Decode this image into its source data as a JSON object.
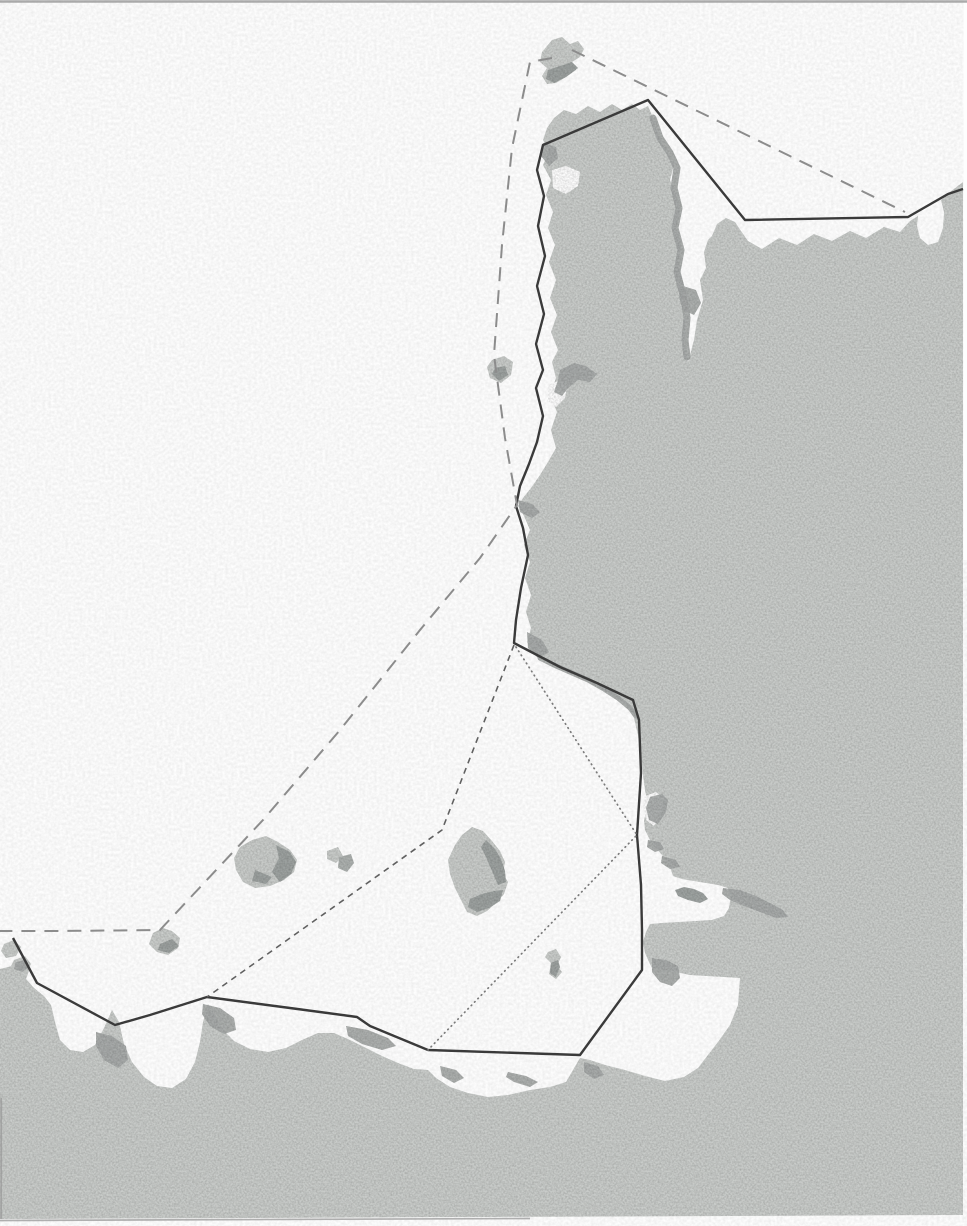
{
  "page": {
    "description": "Scanned grayscale nautical-style map of the Gulf of Saint-Malo / Channel Islands area; coastlines in light gray with darker shaded patches, maritime boundary lines drawn as solid, long-dash, short-dash and dotted strokes. No text labels are visible.",
    "labels": [],
    "width": 967,
    "height": 1226
  },
  "map": {
    "colors": {
      "sea": "#fefefe",
      "land": "#cacdcb",
      "land_shadow": "#a5a9a7",
      "island_shadow": "#9ba09e",
      "boundary_solid": "#3a3a3a",
      "boundary_long_dash": "#8c8c8c",
      "boundary_short_dash": "#606060",
      "boundary_dotted": "#7a7a7a",
      "page_edge": "#979797"
    },
    "line_styles": {
      "solid": {
        "color": "#3a3a3a",
        "width": 2.4,
        "dash": ""
      },
      "long-dash": {
        "color": "#8c8c8c",
        "width": 2.0,
        "dash": "14 9"
      },
      "short-dash": {
        "color": "#606060",
        "width": 1.6,
        "dash": "6 5"
      },
      "dotted": {
        "color": "#7a7a7a",
        "width": 1.7,
        "dash": "0.6 4.2",
        "cap": "round"
      }
    },
    "landmasses": [
      {
        "name": "mainland-france-and-brittany",
        "d": "M963,182 L950,192 941,200 944,212 943,228 938,242 928,245 920,238 917,226 918,216 910,221 900,232 884,227 866,238 850,231 832,241 814,234 797,245 779,238 762,249 748,241 741,231 735,222 726,218 717,224 712,236 708,240 704,252 706,268 700,280 703,300 697,320 694,340 690,355 688,362 684,345 686,325 681,305 684,285 678,265 681,245 676,228 680,210 676,195 670,180 674,165 666,150 658,135 654,120 648,106 640,110 632,104 622,110 612,104 600,112 588,106 576,114 564,110 554,118 547,128 543,140 549,152 543,165 551,180 546,195 553,212 548,228 555,245 549,262 556,280 550,298 557,315 551,332 558,350 552,362 556,378 550,395 557,412 551,430 556,448 548,462 540,475 531,488 523,498 518,506 524,516 530,530 524,545 530,562 525,578 531,595 526,612 531,628 527,642 533,650 545,660 560,668 574,674 588,681 602,689 616,697 628,706 634,718 638,735 641,755 643,775 645,790 648,805 644,820 645,830 650,840 656,848 662,855 668,862 671,870 673,876 682,879 694,881 706,883 718,885 728,888 731,896 729,908 724,916 712,920 696,921 678,922 662,923 650,924 646,932 643,942 645,953 649,962 652,968 662,969 690,975 740,978 738,1005 730,1025 718,1042 708,1055 698,1068 684,1077 665,1081 645,1076 625,1070 605,1065 590,1060 580,1058 566,1082 550,1087 530,1090 508,1095 488,1097 468,1093 450,1087 436,1078 428,1070 414,1069 398,1063 382,1056 366,1048 350,1040 334,1033 318,1033 302,1040 286,1048 268,1052 250,1049 234,1041 223,1030 215,1016 208,1004 203,1022 200,1042 195,1062 186,1079 172,1088 157,1086 144,1077 132,1062 124,1044 119,1022 112,1010 104,1028 95,1045 83,1052 70,1050 60,1040 55,1022 51,1005 44,996 34,988 26,979 30,968 22,960 12,966 0,969 0,1219 963,1215 Z"
      }
    ],
    "islands": [
      {
        "name": "alderney-island",
        "d": "M552,40 L562,37 570,44 578,41 584,49 580,57 572,62 576,70 566,77 556,83 547,84 542,76 547,68 540,62 542,52 Z"
      },
      {
        "name": "casquets-islet",
        "d": "M492,360 L504,356 513,362 511,375 501,383 490,378 487,367 Z"
      },
      {
        "name": "guernsey-island",
        "d": "M240,847 L252,840 266,836 278,842 290,850 297,860 294,872 284,880 270,886 255,888 243,882 236,870 234,858 Z"
      },
      {
        "name": "herm-islet",
        "d": "M327,851 L338,847 343,856 336,863 327,859 Z"
      },
      {
        "name": "sark-islet",
        "fill": "#aeb2b0",
        "d": "M339,857 L351,854 354,863 347,872 338,868 Z"
      },
      {
        "name": "jersey-island",
        "d": "M455,845 L462,835 472,827 483,831 492,841 500,851 505,862 503,874 508,882 504,894 496,903 487,911 477,916 467,912 461,900 455,888 450,874 448,860 Z"
      },
      {
        "name": "roches-douvres-islet",
        "d": "M153,933 L163,928 172,931 180,938 178,948 168,955 157,952 149,944 Z"
      },
      {
        "name": "minquiers-islet",
        "d": "M548,952 L556,949 561,957 557,966 562,972 556,979 549,974 551,963 545,957 Z"
      },
      {
        "name": "brittany-west-islet-a",
        "d": "M4,944 L14,940 21,947 16,956 6,958 1,951 Z"
      },
      {
        "name": "brittany-west-islet-b",
        "d": "M14,960 L25,956 31,964 26,973 16,975 10,968 Z"
      }
    ],
    "water_cutouts": [
      {
        "name": "west-coast-inlet",
        "d": "M548,385 L558,381 567,387 565,398 556,407 548,401 Z"
      },
      {
        "name": "north-coast-pocket",
        "d": "M552,170 L566,166 580,172 578,186 566,194 553,188 Z"
      },
      {
        "name": "regneville-inlet",
        "d": "M645,796 L656,792 664,798 662,812 654,826 646,820 643,806 Z"
      }
    ],
    "shadows": [
      {
        "name": "cotentin-east-coast-shading",
        "mode": "stroke",
        "width": 7,
        "d": "M653,118 L660,138 670,153 677,168 674,188 679,208 675,228 681,250 677,272 683,295 687,318 685,340 687,357"
      },
      {
        "name": "estuary-shading",
        "d": "M683,286 L696,290 701,303 694,315 683,310 679,297 Z"
      },
      {
        "name": "north-cape-shading",
        "d": "M543,143 L556,147 558,158 549,166 541,156 Z"
      },
      {
        "name": "west-coast-wing-shading",
        "d": "M560,370 L574,363 586,366 597,374 590,382 578,380 568,388 562,396 554,392 558,380 Z"
      },
      {
        "name": "carteret-cape-shading",
        "d": "M518,500 L532,504 540,512 532,518 520,512 Z"
      },
      {
        "name": "cape-shading-2",
        "d": "M527,632 L542,640 549,652 538,658 528,648 Z"
      },
      {
        "name": "southeast-coast-shading",
        "mode": "stroke",
        "width": 5,
        "d": "M540,658 L556,666 572,673 588,680 604,689 618,698 630,708 636,716"
      },
      {
        "name": "inlet-shading",
        "d": "M650,797 L662,794 668,800 666,812 658,824 649,820 646,808 Z"
      },
      {
        "name": "coast-notch-shading-a",
        "d": "M648,840 L660,842 664,849 655,852 647,847 Z"
      },
      {
        "name": "coast-notch-shading-b",
        "d": "M662,856 L676,860 680,867 670,869 661,863 Z"
      },
      {
        "name": "chausey-bay-shore-shading",
        "d": "M723,888 L740,890 756,896 770,903 783,910 788,917 776,918 760,912 744,906 730,900 722,894 Z"
      },
      {
        "name": "granville-shading",
        "d": "M652,958 L666,960 678,966 680,978 672,986 660,982 652,972 Z"
      },
      {
        "name": "mont-bay-west-shading",
        "d": "M584,1062 L598,1066 604,1075 594,1079 584,1072 Z"
      },
      {
        "name": "brittany-shading-a",
        "d": "M96,1032 L112,1036 126,1046 128,1060 118,1068 104,1060 96,1046 Z"
      },
      {
        "name": "brittany-headland-shading",
        "d": "M203,1004 L220,1008 234,1018 236,1030 224,1034 210,1026 202,1014 Z"
      },
      {
        "name": "brittany-shading-b",
        "d": "M346,1026 L368,1030 388,1038 396,1046 382,1050 362,1044 348,1036 Z"
      },
      {
        "name": "brittany-shading-c",
        "d": "M440,1066 L456,1070 464,1078 454,1083 442,1076 Z"
      },
      {
        "name": "brittany-shading-d",
        "d": "M508,1072 L526,1076 538,1082 530,1087 514,1082 506,1077 Z"
      },
      {
        "name": "west-islet-shading",
        "d": "M16,962 L26,960 29,967 22,972 14,969 Z"
      }
    ],
    "island_shadows": [
      {
        "name": "alderney-shading",
        "d": "M548,70 L560,66 572,62 578,68 566,77 554,83 546,79 Z"
      },
      {
        "name": "casquets-shading",
        "d": "M495,368 L505,366 508,375 499,381 492,374 Z"
      },
      {
        "name": "guernsey-east-shading",
        "d": "M276,845 L290,852 296,862 291,874 280,882 272,872 279,858 Z"
      },
      {
        "name": "guernsey-south-shading",
        "d": "M255,870 L272,877 266,884 252,881 Z"
      },
      {
        "name": "jersey-east-shading",
        "d": "M486,840 L495,849 501,859 505,871 506,882 498,885 492,871 486,857 481,847 Z"
      },
      {
        "name": "jersey-south-shading",
        "d": "M470,899 L482,894 494,891 503,890 500,901 489,908 477,912 468,907 Z"
      },
      {
        "name": "roches-douvres-shading",
        "d": "M160,944 L172,939 179,946 169,953 158,950 Z"
      },
      {
        "name": "minquiers-shading",
        "d": "M551,963 L558,960 560,967 556,977 550,973 Z"
      },
      {
        "name": "chausey-rocks",
        "d": "M675,890 L684,887 694,889 703,893 708,899 700,903 688,900 678,896 Z"
      }
    ],
    "boundaries": [
      {
        "name": "territorial-limit-solid-line",
        "style": "solid",
        "d": "M963,189 L948,194 908,217 745,220 648,100 543,145 537,170 544,196 538,226 545,256 537,286 544,314 536,344 543,370 536,388 543,416 537,442 529,464 520,486 516,506 523,528 528,555 521,588 516,620 514,643 560,667 597,683 633,700 639,720 641,773 637,835 641,885 642,930 642,970 580,1055 428,1050 370,1026 357,1017 290,1008 207,997 150,1015 115,1025 37,983 13,938"
      },
      {
        "name": "median-long-dash-line-east",
        "style": "long-dash",
        "d": "M572,50 L905,212"
      },
      {
        "name": "median-long-dash-line-west",
        "style": "long-dash",
        "d": "M552,58 L530,62 512,148 502,245 494,355 505,438 517,505 480,558 420,630 340,730 263,820 160,930 60,931 0,931"
      },
      {
        "name": "boundary-short-dash-line",
        "style": "short-dash",
        "d": "M514,645 L442,830 207,997"
      },
      {
        "name": "boundary-dotted-line",
        "style": "dotted",
        "d": "M516,647 L637,835 428,1050"
      }
    ],
    "edge_lines": [
      {
        "name": "scan-edge-top",
        "x1": 0,
        "y1": 1.5,
        "x2": 967,
        "y2": 1.5,
        "width": 2.4,
        "opacity": 0.8
      },
      {
        "name": "scan-edge-bottom",
        "x1": 0,
        "y1": 1220.5,
        "x2": 530,
        "y2": 1218.5,
        "width": 1.7,
        "opacity": 0.75
      },
      {
        "name": "scan-edge-left",
        "x1": 1.2,
        "y1": 1098,
        "x2": 1.2,
        "y2": 1219,
        "width": 1.8,
        "opacity": 0.7
      }
    ],
    "right_margin": {
      "name": "page-right-margin",
      "x": 963.5,
      "y": 0,
      "w": 3.5,
      "h": 560
    }
  }
}
